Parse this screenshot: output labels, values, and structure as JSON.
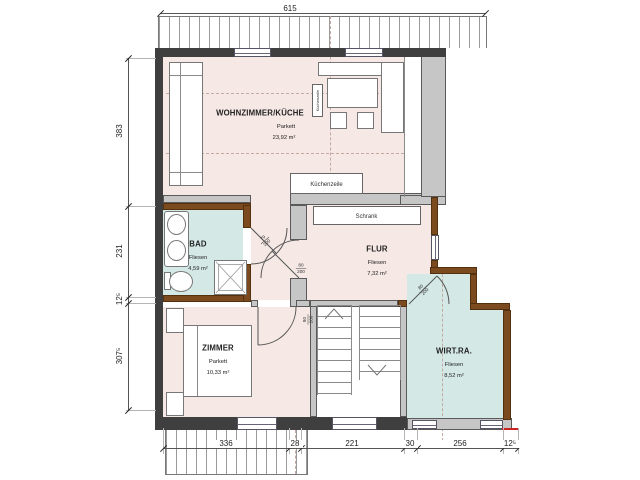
{
  "rooms": {
    "wohnzimmer": {
      "name": "WOHNZIMMER/KÜCHE",
      "floor": "Parkett",
      "area": "23,92 m²"
    },
    "bad": {
      "name": "BAD",
      "floor": "Fliesen",
      "area": "4,59 m²"
    },
    "flur": {
      "name": "FLUR",
      "floor": "Fliesen",
      "area": "7,32 m²"
    },
    "zimmer": {
      "name": "ZIMMER",
      "floor": "Parkett",
      "area": "10,33 m²"
    },
    "wirtschaftsraum": {
      "name": "WIRT.RA.",
      "floor": "Fliesen",
      "area": "8,52 m²"
    }
  },
  "fixtures": {
    "schrank_label": "Schrank",
    "kuechenzeile_label": "Küchenzeile",
    "kuechenzeile_vertical_label": "Küchenzeile"
  },
  "doors": {
    "bad": {
      "w": "79",
      "h": "200"
    },
    "flur": {
      "w": "80",
      "h": "200"
    },
    "zimmer": {
      "w": "80",
      "h": "200"
    },
    "wirtschaftsraum": {
      "w": "80",
      "h": "200"
    }
  },
  "dimensions": {
    "top_total": "615",
    "left_chain": [
      "383",
      "231",
      "12⁵",
      "307⁵"
    ],
    "bottom_chain": [
      "336",
      "28",
      "221",
      "30",
      "256",
      "12⁵"
    ]
  },
  "colors": {
    "room_pink": "#f6e8e4",
    "room_cyan": "#d4e9e5",
    "wall_dark": "#3f3f3f",
    "wall_gray": "#c6c6c6",
    "wall_brown": "#7b4a1e",
    "accent_red": "#cc2222"
  }
}
